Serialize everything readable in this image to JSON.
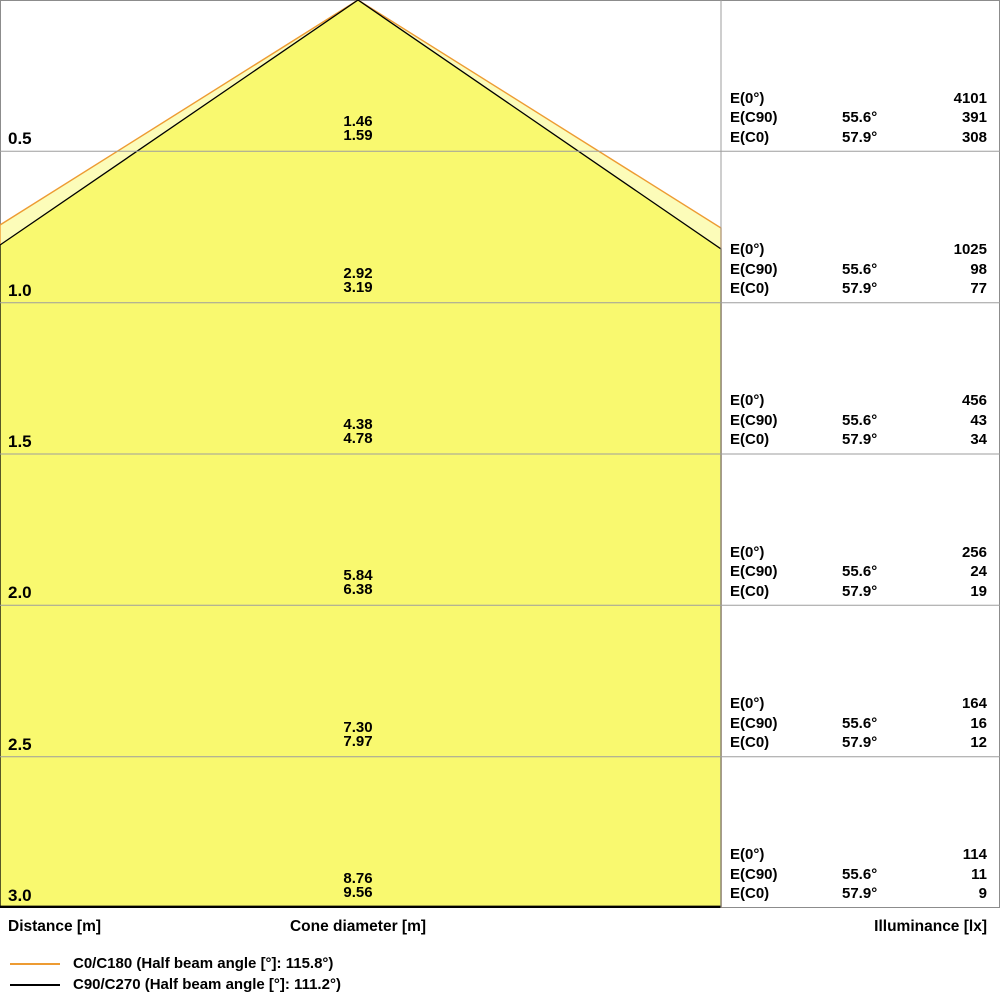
{
  "colors": {
    "beam_c0_fill": "#FCFCB9",
    "beam_c0_stroke": "#ED9B33",
    "beam_c90_fill": "#F9F96F",
    "beam_c90_stroke": "#000000",
    "grid": "#9E9E9E",
    "border": "#8C8C8C",
    "text": "#000000"
  },
  "axis": {
    "distance": "Distance [m]",
    "cone_diameter": "Cone diameter [m]",
    "illuminance": "Illuminance [lx]"
  },
  "legend": [
    {
      "name": "C0/C180",
      "label": "C0/C180 (Half beam angle [°]: 115.8°)",
      "color": "#ED9B33"
    },
    {
      "name": "C90/C270",
      "label": "C90/C270 (Half beam angle [°]: 111.2°)",
      "color": "#000000"
    }
  ],
  "rows": [
    {
      "distance": "0.5",
      "cone_diameters": [
        "1.46",
        "1.59"
      ],
      "illuminance": [
        {
          "label": "E(0°)",
          "angle": "",
          "value": "4101"
        },
        {
          "label": "E(C90)",
          "angle": "55.6°",
          "value": "391"
        },
        {
          "label": "E(C0)",
          "angle": "57.9°",
          "value": "308"
        }
      ]
    },
    {
      "distance": "1.0",
      "cone_diameters": [
        "2.92",
        "3.19"
      ],
      "illuminance": [
        {
          "label": "E(0°)",
          "angle": "",
          "value": "1025"
        },
        {
          "label": "E(C90)",
          "angle": "55.6°",
          "value": "98"
        },
        {
          "label": "E(C0)",
          "angle": "57.9°",
          "value": "77"
        }
      ]
    },
    {
      "distance": "1.5",
      "cone_diameters": [
        "4.38",
        "4.78"
      ],
      "illuminance": [
        {
          "label": "E(0°)",
          "angle": "",
          "value": "456"
        },
        {
          "label": "E(C90)",
          "angle": "55.6°",
          "value": "43"
        },
        {
          "label": "E(C0)",
          "angle": "57.9°",
          "value": "34"
        }
      ]
    },
    {
      "distance": "2.0",
      "cone_diameters": [
        "5.84",
        "6.38"
      ],
      "illuminance": [
        {
          "label": "E(0°)",
          "angle": "",
          "value": "256"
        },
        {
          "label": "E(C90)",
          "angle": "55.6°",
          "value": "24"
        },
        {
          "label": "E(C0)",
          "angle": "57.9°",
          "value": "19"
        }
      ]
    },
    {
      "distance": "2.5",
      "cone_diameters": [
        "7.30",
        "7.97"
      ],
      "illuminance": [
        {
          "label": "E(0°)",
          "angle": "",
          "value": "164"
        },
        {
          "label": "E(C90)",
          "angle": "55.6°",
          "value": "16"
        },
        {
          "label": "E(C0)",
          "angle": "57.9°",
          "value": "12"
        }
      ]
    },
    {
      "distance": "3.0",
      "cone_diameters": [
        "8.76",
        "9.56"
      ],
      "illuminance": [
        {
          "label": "E(0°)",
          "angle": "",
          "value": "114"
        },
        {
          "label": "E(C90)",
          "angle": "55.6°",
          "value": "11"
        },
        {
          "label": "E(C0)",
          "angle": "57.9°",
          "value": "9"
        }
      ]
    }
  ],
  "chart_data": {
    "type": "line",
    "title": "",
    "xlabel": "Cone diameter [m]",
    "ylabel": "Distance [m]",
    "legend_position": "bottom-left",
    "grid": true,
    "distances_m": [
      0.5,
      1.0,
      1.5,
      2.0,
      2.5,
      3.0
    ],
    "series": [
      {
        "name": "C0/C180",
        "half_beam_angle_deg": 115.8,
        "color": "#ED9B33",
        "cone_diameter_m": [
          1.59,
          3.19,
          4.78,
          6.38,
          7.97,
          9.56
        ]
      },
      {
        "name": "C90/C270",
        "half_beam_angle_deg": 111.2,
        "color": "#000000",
        "cone_diameter_m": [
          1.46,
          2.92,
          4.38,
          5.84,
          7.3,
          8.76
        ]
      }
    ],
    "illuminance_lx": {
      "E0_values": [
        4101,
        1025,
        456,
        256,
        164,
        114
      ],
      "EC90": {
        "angle_deg": 55.6,
        "values": [
          391,
          98,
          43,
          24,
          16,
          11
        ]
      },
      "EC0": {
        "angle_deg": 57.9,
        "values": [
          308,
          77,
          34,
          19,
          12,
          9
        ]
      }
    }
  }
}
